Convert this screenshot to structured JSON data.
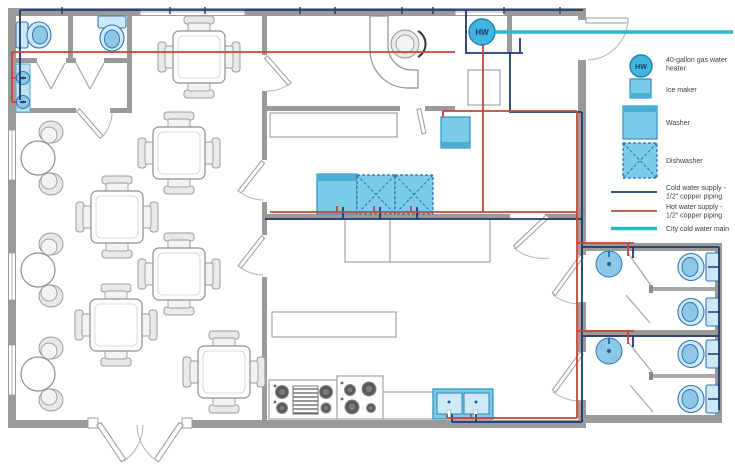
{
  "water_heater_label": "HW",
  "colors": {
    "wall": "#9a9a9a",
    "cold": "#1e3a6d",
    "hot": "#c94434",
    "city": "#29b9cd",
    "fixtureStroke": "#2e75b6",
    "applianceFill": "#7ccbe8",
    "applianceStroke": "#2d8ebe",
    "heaterFill": "#41b6e0"
  },
  "legend": {
    "items": [
      {
        "icon": "water-heater-icon",
        "lines": [
          "40-gallon gas water",
          "heater"
        ]
      },
      {
        "icon": "ice-maker-icon",
        "lines": [
          "Ice maker"
        ]
      },
      {
        "icon": "washer-icon",
        "lines": [
          "Washer"
        ]
      },
      {
        "icon": "dishwasher-icon",
        "lines": [
          "Dishwasher"
        ]
      },
      {
        "icon": "cold-water-line",
        "lines": [
          "Cold water supply -",
          "1/2\" copper piping"
        ]
      },
      {
        "icon": "hot-water-line",
        "lines": [
          "Hot water supply -",
          "1/2\" copper piping"
        ]
      },
      {
        "icon": "city-main-line",
        "lines": [
          "City cold water main"
        ]
      }
    ]
  }
}
